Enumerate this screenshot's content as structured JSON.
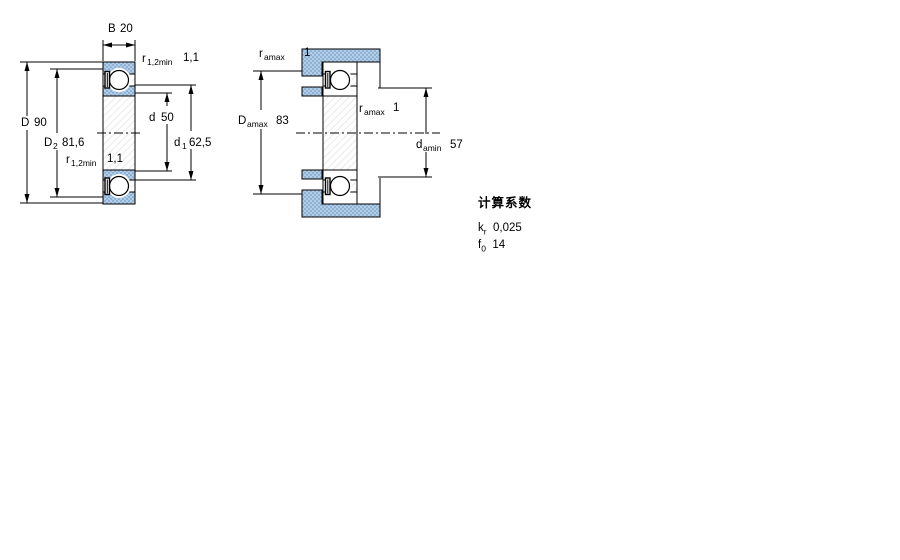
{
  "page": {
    "background": "#ffffff"
  },
  "colors": {
    "section_fill": "#b2cde5",
    "section_dot": "#8fb3d5",
    "line": "#000000",
    "hatch": "#e8e8e8"
  },
  "drawing1": {
    "name": "bearing-cross-section",
    "dims": {
      "B": {
        "sym": "B",
        "sub": "",
        "val": "20"
      },
      "r12_top": {
        "sym": "r",
        "sub": "1,2min",
        "val": "1,1"
      },
      "D": {
        "sym": "D",
        "sub": "",
        "val": "90"
      },
      "D2": {
        "sym": "D",
        "sub": "2",
        "val": "81,6"
      },
      "r12_bottom": {
        "sym": "r",
        "sub": "1,2min",
        "val": "1,1"
      },
      "d": {
        "sym": "d",
        "sub": "",
        "val": "50"
      },
      "d1": {
        "sym": "d",
        "sub": "1",
        "val": "62,5"
      }
    }
  },
  "drawing2": {
    "name": "bearing-mounting-dimensions",
    "dims": {
      "ra_top": {
        "sym": "r",
        "sub": "amax",
        "val": "1"
      },
      "Damax": {
        "sym": "D",
        "sub": "amax",
        "val": "83"
      },
      "ra_mid": {
        "sym": "r",
        "sub": "amax",
        "val": "1"
      },
      "damin": {
        "sym": "d",
        "sub": "amin",
        "val": "57"
      }
    }
  },
  "factors": {
    "title": "计算系数",
    "rows": [
      {
        "sym": "k",
        "sub": "r",
        "val": "0,025"
      },
      {
        "sym": "f",
        "sub": "0",
        "val": "14"
      }
    ]
  }
}
